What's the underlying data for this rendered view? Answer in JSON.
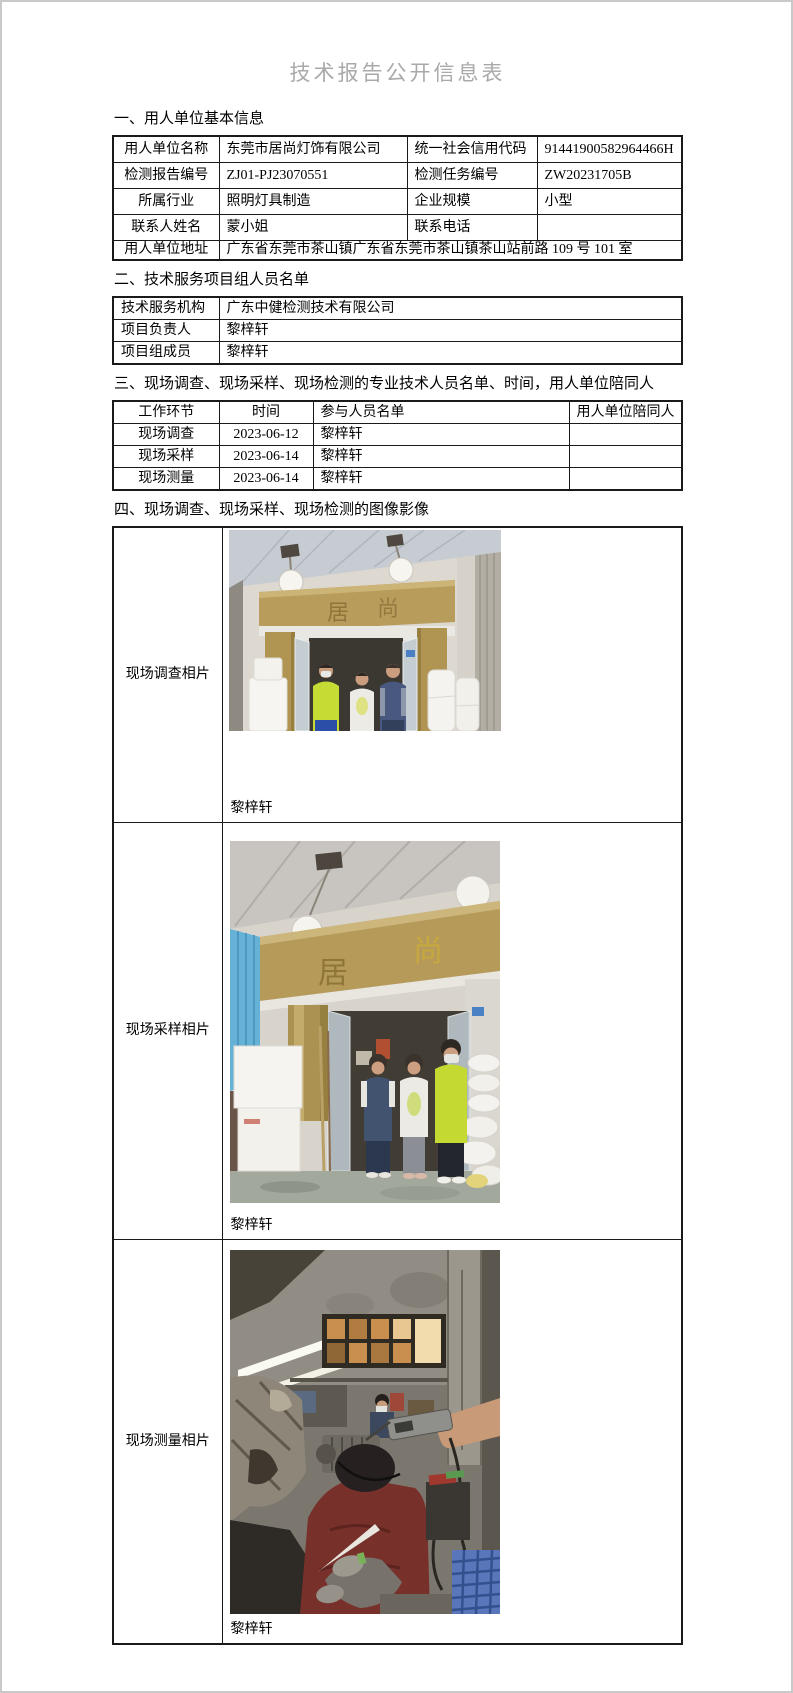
{
  "page": {
    "title": "技术报告公开信息表"
  },
  "sections": {
    "s1": "一、用人单位基本信息",
    "s2": "二、技术服务项目组人员名单",
    "s3": "三、现场调查、现场采样、现场检测的专业技术人员名单、时间，用人单位陪同人",
    "s4": "四、现场调查、现场采样、现场检测的图像影像"
  },
  "employer": {
    "rows": [
      {
        "k1": "用人单位名称",
        "v1": "东莞市居尚灯饰有限公司",
        "k2": "统一社会信用代码",
        "v2": "91441900582964466H"
      },
      {
        "k1": "检测报告编号",
        "v1": "ZJ01-PJ23070551",
        "k2": "检测任务编号",
        "v2": "ZW20231705B"
      },
      {
        "k1": "所属行业",
        "v1": "照明灯具制造",
        "k2": "企业规模",
        "v2": "小型"
      },
      {
        "k1": "联系人姓名",
        "v1": "蒙小姐",
        "k2": "联系电话",
        "v2": ""
      }
    ],
    "address_label": "用人单位地址",
    "address_value": "广东省东莞市茶山镇广东省东莞市茶山镇茶山站前路 109 号 101 室"
  },
  "team": {
    "rows": [
      {
        "label": "技术服务机构",
        "value": "广东中健检测技术有限公司"
      },
      {
        "label": "项目负责人",
        "value": "黎梓轩"
      },
      {
        "label": "项目组成员",
        "value": "黎梓轩"
      }
    ]
  },
  "schedule": {
    "headers": [
      "工作环节",
      "时间",
      "参与人员名单",
      "用人单位陪同人"
    ],
    "rows": [
      {
        "step": "现场调查",
        "date": "2023-06-12",
        "people": "黎梓轩",
        "escort": ""
      },
      {
        "step": "现场采样",
        "date": "2023-06-14",
        "people": "黎梓轩",
        "escort": ""
      },
      {
        "step": "现场测量",
        "date": "2023-06-14",
        "people": "黎梓轩",
        "escort": ""
      }
    ]
  },
  "photos": {
    "survey": {
      "label": "现场调查相片",
      "caption": "黎梓轩",
      "sign_left": "居",
      "sign_right": "尚"
    },
    "sampling": {
      "label": "现场采样相片",
      "caption": "黎梓轩",
      "sign_left": "居",
      "sign_right": "尚"
    },
    "measure": {
      "label": "现场测量相片",
      "caption": "黎梓轩"
    }
  },
  "colors": {
    "title_gray": "#a9a9a9",
    "table_border": "#1a1a1a",
    "sign_gold": "#b59a5a"
  }
}
